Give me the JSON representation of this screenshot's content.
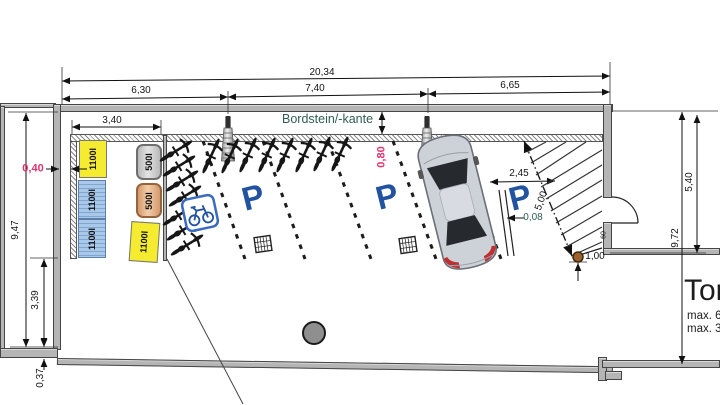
{
  "dims": {
    "overall": "20,34",
    "seg_left": "6,30",
    "seg_mid": "7,40",
    "seg_right": "6,65",
    "bin_width": "3,40",
    "height_left": "9,47",
    "gap_left": "0,40",
    "left_lower": "3,39",
    "wall_bottom": "0,37",
    "curb_gap": "0,80",
    "stall_width": "2,45",
    "step": "0,08",
    "ramp_length": "5,00",
    "tree_offset": "1,00",
    "door_width": "60",
    "height_right": "9,72",
    "height_right_upper": "5,40"
  },
  "labels": {
    "curb": "Bordstein/-kante",
    "parking": "P",
    "gate": "Tor",
    "gate_max1": "max. 6",
    "gate_max2": "max. 3"
  },
  "containers": [
    {
      "label": "1100l",
      "type": "yellow"
    },
    {
      "label": "1100l",
      "type": "blue"
    },
    {
      "label": "1100l",
      "type": "blue"
    },
    {
      "label": "500l",
      "type": "gray"
    },
    {
      "label": "500l",
      "type": "orange"
    },
    {
      "label": "1100l",
      "type": "yellow"
    }
  ],
  "colors": {
    "accent_pink": "#e0336e",
    "accent_teal": "#2f5d52",
    "parking_blue": "#2153a0",
    "bin_yellow": "#f5ec31",
    "bin_blue": "#a9c8ea",
    "bin_blue_stripe": "#7fa6cf",
    "wall_fill": "#b5b5b5",
    "car_body": "#cdd1d8",
    "car_glass": "#26292e"
  }
}
